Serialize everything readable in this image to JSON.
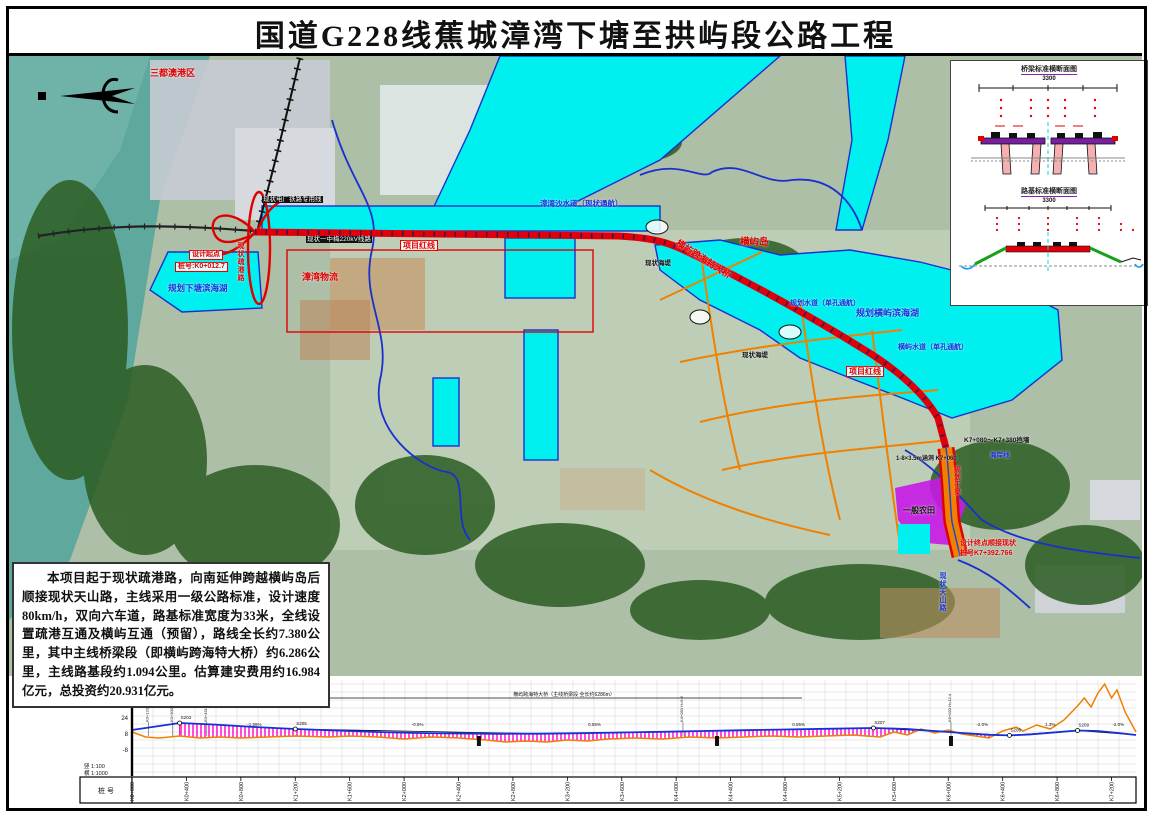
{
  "title": "国道G228线蕉城漳湾下塘至拱屿段公路工程",
  "description": {
    "text": "本项目起于现状疏港路，向南延伸跨越横屿岛后顺接现状天山路，主线采用一级公路标准，设计速度80km/h，双向六车道，路基标准宽度为33米，全线设置疏港互通及横屿互通（预留），路线全长约7.380公里，其中主线桥梁段（即横屿跨海特大桥）约6.286公里，主线路基段约1.094公里。估算建安费用约16.984亿元，总投资约20.931亿元。"
  },
  "map": {
    "labels": [
      {
        "text": "三都澳港区",
        "x": 150,
        "y": 68,
        "c": "r",
        "fs": 9
      },
      {
        "text": "现状电厂铁路专用线",
        "x": 262,
        "y": 196,
        "c": "inv"
      },
      {
        "text": "现状一中梅220kV线路",
        "x": 306,
        "y": 236,
        "c": "inv"
      },
      {
        "text": "现状疏港路",
        "x": 236,
        "y": 242,
        "c": "r",
        "v": true,
        "fs": 7
      },
      {
        "text": "设计起点",
        "x": 189,
        "y": 250,
        "c": "r",
        "box": true,
        "fs": 7
      },
      {
        "text": "桩号:K0+012.7",
        "x": 175,
        "y": 262,
        "c": "r",
        "box": true,
        "fs": 7
      },
      {
        "text": "规划下塘滨海湖",
        "x": 168,
        "y": 284,
        "c": "b",
        "fs": 8.5
      },
      {
        "text": "漳湾物流",
        "x": 302,
        "y": 272,
        "c": "r",
        "fs": 9
      },
      {
        "text": "项目红线",
        "x": 400,
        "y": 240,
        "c": "r",
        "box": true,
        "fs": 8
      },
      {
        "text": "漳湾沙水道（现状通航）",
        "x": 540,
        "y": 200,
        "c": "b",
        "fs": 7.5
      },
      {
        "text": "现状海堤",
        "x": 645,
        "y": 260,
        "c": "d",
        "fs": 6.5
      },
      {
        "text": "横屿岛",
        "x": 740,
        "y": 238,
        "c": "r",
        "fs": 9.5
      },
      {
        "text": "横屿跨海特大桥",
        "x": 672,
        "y": 254,
        "c": "r",
        "fs": 9,
        "rot": 33
      },
      {
        "text": "规划水道（单孔通航）",
        "x": 790,
        "y": 300,
        "c": "b",
        "fs": 7
      },
      {
        "text": "规划横屿滨海湖",
        "x": 856,
        "y": 308,
        "c": "b",
        "fs": 9
      },
      {
        "text": "横屿水道（单孔通航）",
        "x": 898,
        "y": 344,
        "c": "b",
        "fs": 7
      },
      {
        "text": "项目红线",
        "x": 846,
        "y": 366,
        "c": "r",
        "box": true,
        "fs": 8
      },
      {
        "text": "现状海堤",
        "x": 742,
        "y": 352,
        "c": "d",
        "fs": 6.5
      },
      {
        "text": "K7+080～K7+380挡墙",
        "x": 964,
        "y": 437,
        "c": "d",
        "fs": 6.5
      },
      {
        "text": "海岸线",
        "x": 990,
        "y": 452,
        "c": "b",
        "fs": 6.5
      },
      {
        "text": "1-8×3.5m涵洞 K7+060",
        "x": 896,
        "y": 456,
        "c": "d",
        "fs": 6
      },
      {
        "text": "规划干渠",
        "x": 952,
        "y": 466,
        "c": "r",
        "v": true,
        "fs": 6.5
      },
      {
        "text": "一般农田",
        "x": 903,
        "y": 506,
        "c": "d",
        "fs": 8
      },
      {
        "text": "设计终点顺接现状",
        "x": 960,
        "y": 540,
        "c": "r",
        "fs": 7
      },
      {
        "text": "桩号K7+392.766",
        "x": 960,
        "y": 550,
        "c": "r",
        "fs": 7
      },
      {
        "text": "现状天山路",
        "x": 938,
        "y": 572,
        "c": "b",
        "v": true,
        "fs": 7
      }
    ]
  },
  "inset": {
    "bridge_section": {
      "title": "桥梁标准横断面图",
      "overall_width": "3300",
      "parts": [
        {
          "t": "50"
        },
        {
          "t": "1575"
        },
        {
          "t": "50"
        },
        {
          "t": "1575"
        },
        {
          "t": "50"
        }
      ]
    },
    "roadbed_section": {
      "title": "路基标准横断面图",
      "overall_width": "3300",
      "parts": [
        {
          "t": "75"
        },
        {
          "t": "300"
        },
        {
          "t": "1125"
        },
        {
          "t": "300"
        },
        {
          "t": "1125"
        },
        {
          "t": "300"
        },
        {
          "t": "75"
        }
      ]
    }
  },
  "profile": {
    "scale_v": "竖 1:100",
    "scale_h": "横 1:1000",
    "station_row_label": "桩 号",
    "y_ticks": [
      "56",
      "40",
      "24",
      "8",
      "-8"
    ],
    "bridge_span_label": "横屿跨海特大桥（主线桥梁段 全长约6286m）",
    "stations": [
      "K0+000",
      "K0+400",
      "K0+800",
      "K1+200",
      "K1+600",
      "K2+000",
      "K2+400",
      "K2+800",
      "K3+200",
      "K3+600",
      "K4+000",
      "K4+400",
      "K4+800",
      "K5+200",
      "K5+600",
      "K6+000",
      "K6+400",
      "K6+800",
      "K7+200"
    ]
  },
  "chart_data": {
    "type": "line",
    "title": "路线纵断面图",
    "xlabel": "桩号",
    "ylabel": "标高(m)",
    "x_unit": "km",
    "xlim": [
      0,
      7.38
    ],
    "ylim": [
      -16,
      56
    ],
    "grid": true,
    "series": [
      {
        "name": "地面线",
        "color": "#f08000",
        "points": [
          [
            0,
            8
          ],
          [
            0.1,
            3
          ],
          [
            0.2,
            2
          ],
          [
            0.35,
            4
          ],
          [
            0.5,
            2
          ],
          [
            0.65,
            3
          ],
          [
            0.8,
            2
          ],
          [
            1.0,
            3
          ],
          [
            1.2,
            4
          ],
          [
            1.45,
            3
          ],
          [
            1.6,
            4
          ],
          [
            1.8,
            3
          ],
          [
            2.0,
            1
          ],
          [
            2.2,
            3
          ],
          [
            2.4,
            2
          ],
          [
            2.6,
            0
          ],
          [
            2.75,
            -2
          ],
          [
            2.9,
            -1
          ],
          [
            3.05,
            -2
          ],
          [
            3.2,
            0
          ],
          [
            3.35,
            -1
          ],
          [
            3.5,
            1
          ],
          [
            3.7,
            2
          ],
          [
            3.9,
            1
          ],
          [
            4.1,
            3
          ],
          [
            4.3,
            2
          ],
          [
            4.5,
            3
          ],
          [
            4.7,
            4
          ],
          [
            4.9,
            3
          ],
          [
            5.1,
            4
          ],
          [
            5.3,
            5
          ],
          [
            5.5,
            3
          ],
          [
            5.6,
            8
          ],
          [
            5.7,
            5
          ],
          [
            5.8,
            11
          ],
          [
            5.9,
            7
          ],
          [
            6.0,
            10
          ],
          [
            6.1,
            6
          ],
          [
            6.2,
            4
          ],
          [
            6.3,
            2
          ],
          [
            6.4,
            9
          ],
          [
            6.5,
            13
          ],
          [
            6.55,
            9
          ],
          [
            6.65,
            15
          ],
          [
            6.75,
            11
          ],
          [
            6.85,
            20
          ],
          [
            6.95,
            34
          ],
          [
            7.0,
            42
          ],
          [
            7.05,
            33
          ],
          [
            7.1,
            47
          ],
          [
            7.15,
            56
          ],
          [
            7.2,
            42
          ],
          [
            7.24,
            50
          ],
          [
            7.3,
            28
          ],
          [
            7.38,
            8
          ]
        ]
      },
      {
        "name": "设计线",
        "color": "#1530d8",
        "points": [
          [
            0,
            10
          ],
          [
            0.2,
            14
          ],
          [
            0.35,
            17
          ],
          [
            0.6,
            15.5
          ],
          [
            0.9,
            13
          ],
          [
            1.2,
            11
          ],
          [
            1.5,
            9.5
          ],
          [
            1.8,
            8
          ],
          [
            2.1,
            7
          ],
          [
            2.4,
            6.5
          ],
          [
            2.7,
            6.2
          ],
          [
            3.0,
            6.3
          ],
          [
            3.3,
            6.8
          ],
          [
            3.6,
            7.5
          ],
          [
            3.9,
            8.2
          ],
          [
            4.2,
            9
          ],
          [
            4.5,
            9.8
          ],
          [
            4.8,
            10.5
          ],
          [
            5.1,
            11.2
          ],
          [
            5.45,
            12
          ],
          [
            5.7,
            11
          ],
          [
            5.9,
            9
          ],
          [
            6.1,
            7
          ],
          [
            6.3,
            5.2
          ],
          [
            6.45,
            4.6
          ],
          [
            6.6,
            5.5
          ],
          [
            6.8,
            7.8
          ],
          [
            6.95,
            9.5
          ],
          [
            7.1,
            9
          ],
          [
            7.25,
            7
          ],
          [
            7.38,
            5
          ]
        ]
      }
    ],
    "bridge_extent_km": [
      0.35,
      6.35
    ],
    "tangent_points": [
      [
        0,
        10
      ],
      [
        0.35,
        17
      ],
      [
        1.2,
        11
      ],
      [
        3.0,
        6.3
      ],
      [
        5.45,
        12
      ],
      [
        6.45,
        4.6
      ],
      [
        6.95,
        9.5
      ],
      [
        7.38,
        5
      ]
    ],
    "vc_markers": [
      {
        "x": 0.35,
        "e": 17,
        "t": "S203"
      },
      {
        "x": 1.2,
        "e": 11,
        "t": "S205"
      },
      {
        "x": 5.45,
        "e": 12,
        "t": "S207"
      },
      {
        "x": 6.45,
        "e": 4.6,
        "t": "S208"
      },
      {
        "x": 6.95,
        "e": 9.5,
        "t": "S209"
      }
    ],
    "grade_labels": [
      {
        "x": 0.9,
        "t": "-1.55%"
      },
      {
        "x": 2.1,
        "t": "-0.5%"
      },
      {
        "x": 3.4,
        "t": "0.55%"
      },
      {
        "x": 4.9,
        "t": "0.55%"
      },
      {
        "x": 6.25,
        "t": "-2.0%"
      },
      {
        "x": 6.75,
        "t": "1.3%"
      },
      {
        "x": 7.25,
        "t": "-2.0%"
      }
    ],
    "annotations": [
      {
        "x": 0.12,
        "t": "K0+123.5 H=16.8"
      },
      {
        "x": 0.3,
        "t": "K0+300.0 H=16.2"
      },
      {
        "x": 0.55,
        "t": "K0+451.5 H=15.6"
      },
      {
        "x": 4.05,
        "t": "K4+050 H=9.6"
      },
      {
        "x": 6.02,
        "t": "K6+020 H=12.4"
      }
    ],
    "culvert_marks_km": [
      2.55,
      4.3,
      6.02
    ]
  }
}
